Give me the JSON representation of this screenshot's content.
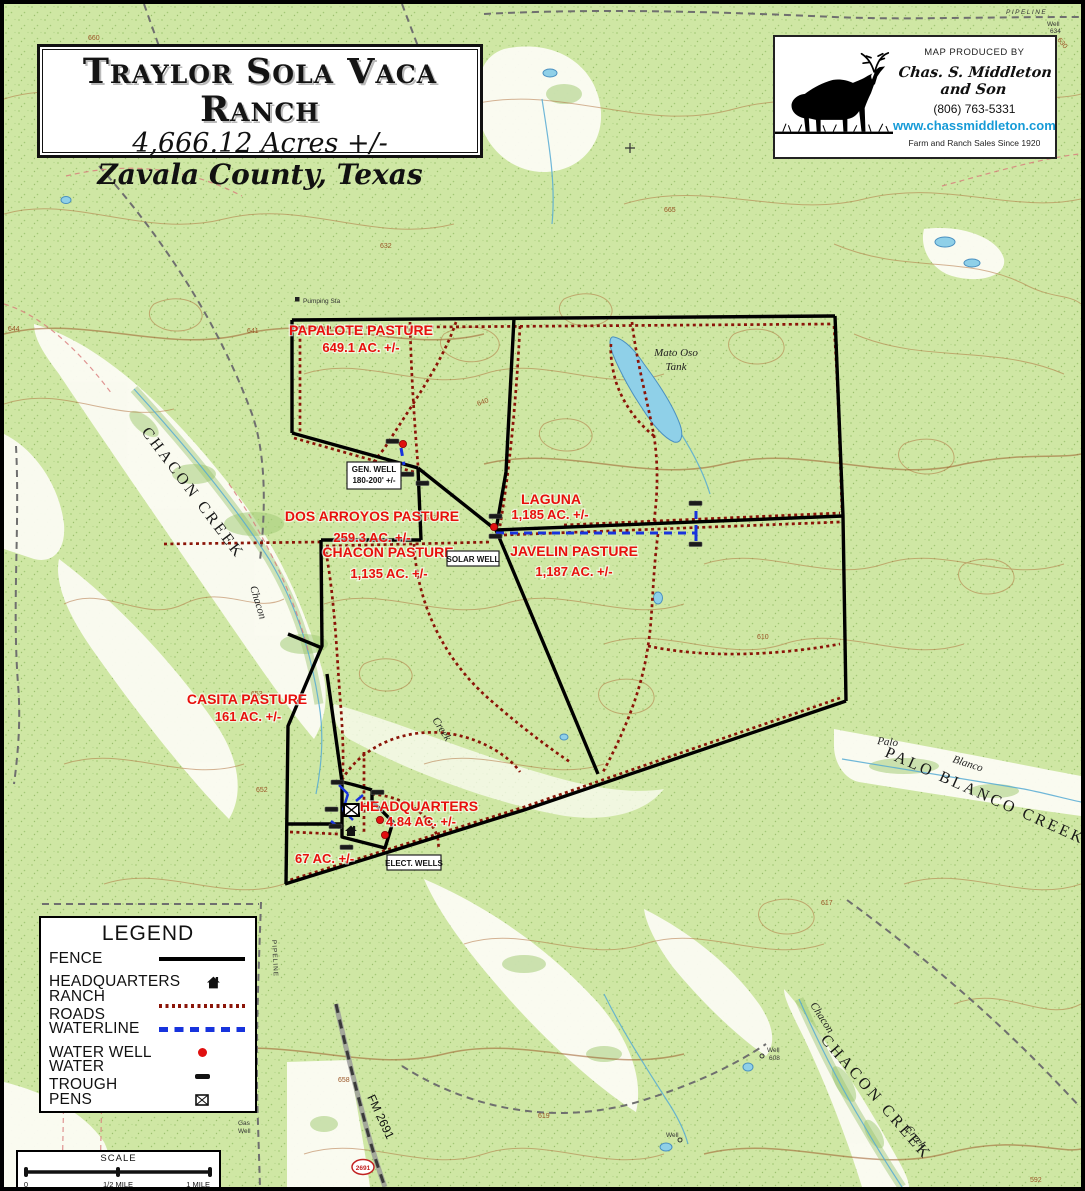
{
  "colors": {
    "pasture_label": "#e8100d",
    "ranch_road": "#8b1408",
    "waterline": "#1733dd",
    "fence": "#000000",
    "water_well": "#e01010",
    "website_link": "#169bd7",
    "map_green": "#cfe7a4",
    "water_blue": "#8fd0e8"
  },
  "title_box": {
    "name": "Traylor Sola Vaca Ranch",
    "acreage": "4,666.12 Acres +/-",
    "location": "Zavala County, Texas"
  },
  "producer_box": {
    "produced_by": "MAP PRODUCED BY",
    "company": "Chas. S. Middleton and Son",
    "phone": "(806) 763-5331",
    "website": "www.chassmiddleton.com",
    "tagline": "Farm and Ranch Sales Since 1920",
    "logo_icon": "deer-silhouette"
  },
  "legend": {
    "title": "LEGEND",
    "items": [
      {
        "label": "FENCE",
        "symbol": "solid-black-line"
      },
      {
        "label": "HEADQUARTERS",
        "symbol": "house-icon"
      },
      {
        "label": "RANCH ROADS",
        "symbol": "dark-red-dotted-line"
      },
      {
        "label": "WATERLINE",
        "symbol": "blue-dashed-line"
      },
      {
        "label": "WATER WELL",
        "symbol": "red-dot"
      },
      {
        "label": "WATER TROUGH",
        "symbol": "black-dash"
      },
      {
        "label": "PENS",
        "symbol": "boxed-x-icon"
      }
    ]
  },
  "scale_bar": {
    "title": "SCALE",
    "tick0": "0",
    "tick_half": "1/2 MILE",
    "tick_full": "1 MILE"
  },
  "pastures": {
    "papalote": {
      "name": "PAPALOTE PASTURE",
      "acres": "649.1 AC. +/-"
    },
    "dos_arroyos": {
      "name": "DOS ARROYOS PASTURE",
      "acres": "259.3 AC. +/-"
    },
    "laguna": {
      "name": "LAGUNA",
      "acres": "1,185 AC. +/-"
    },
    "chacon": {
      "name": "CHACON PASTURE",
      "acres": "1,135 AC. +/-"
    },
    "javelin": {
      "name": "JAVELIN PASTURE",
      "acres": "1,187 AC. +/-"
    },
    "casita": {
      "name": "CASITA PASTURE",
      "acres": "161 AC. +/-"
    },
    "headquarters": {
      "name": "HEADQUARTERS",
      "acres": "4.84 AC. +/-"
    },
    "small_parcel": {
      "acres": "67 AC. +/-"
    }
  },
  "well_boxes": {
    "gen_well_1": "GEN. WELL",
    "gen_well_2": "180-200' +/-",
    "solar_well": "SOLAR WELL",
    "elect_wells": "ELECT. WELLS"
  },
  "topo_labels": {
    "pumping_sta": "Pumping Sta",
    "chacon_creek_nw": "CHACON CREEK",
    "chacon_cursive_nw": "Chacon",
    "creek_cursive_mid": "Creek",
    "mato_oso_1": "Mato Oso",
    "mato_oso_2": "Tank",
    "palo_cursive": "Palo",
    "blanco_cursive": "Blanco",
    "palo_blanco_creek": "PALO BLANCO CREEK",
    "chacon_creek_se": "CHACON CREEK",
    "chacon_cursive_se": "Chacon",
    "creek_cursive_se": "Creek",
    "fm_2691": "FM 2691",
    "fm_shield": "2691",
    "pipeline_top": "PIPELINE",
    "pipeline_west": "PIPELINE",
    "well_top_1": "Well",
    "well_top_2": "634",
    "well_608_1": "Well",
    "well_608_2": "608",
    "well_bottom": "Well",
    "gas_well_1": "Gas",
    "gas_well_2": "Well"
  },
  "contour_labels": [
    "660",
    "644",
    "641",
    "637",
    "640",
    "653",
    "652",
    "610",
    "617",
    "658",
    "619",
    "630",
    "592",
    "632",
    "665"
  ]
}
